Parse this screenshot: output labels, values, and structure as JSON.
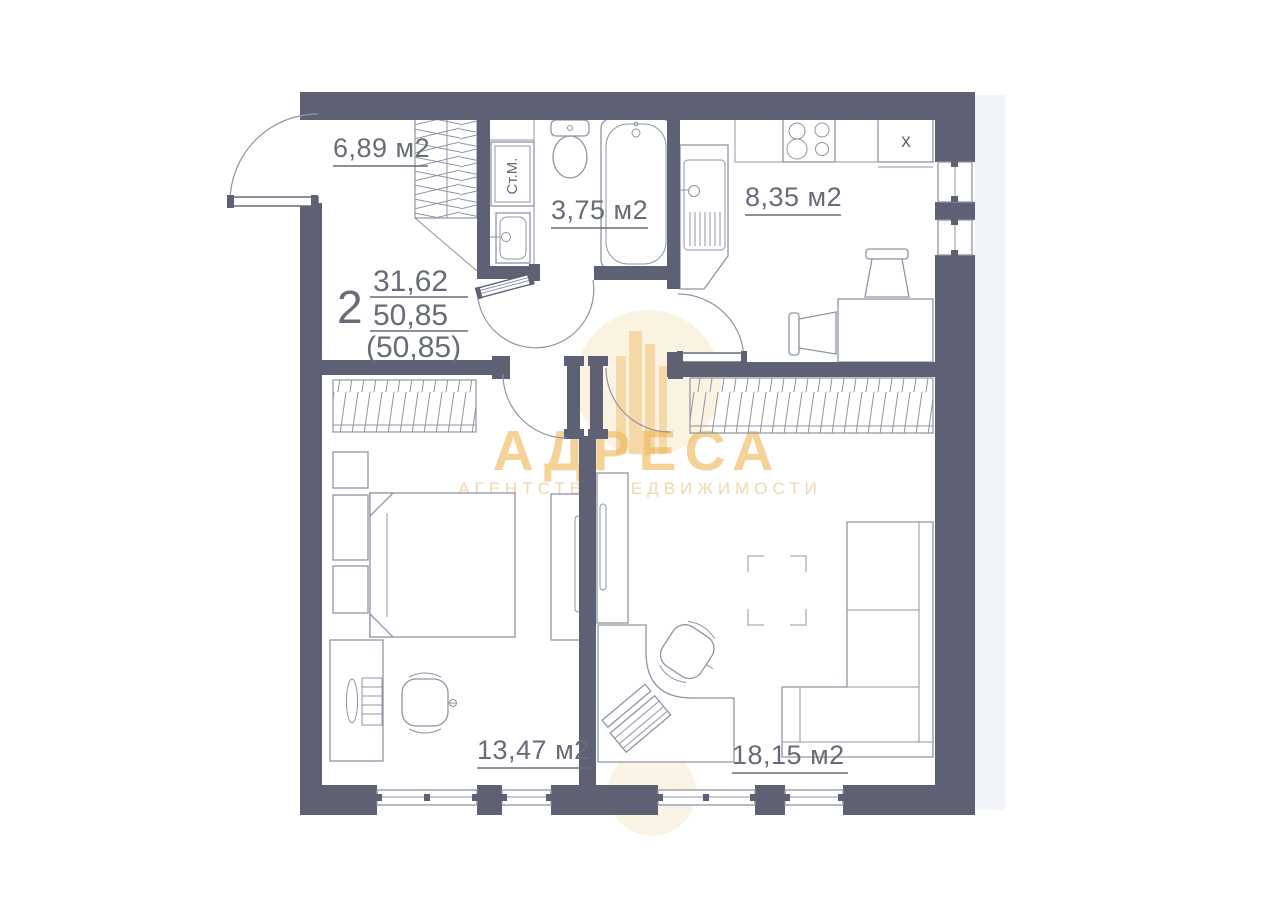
{
  "plan": {
    "apartment": {
      "number": "2",
      "area_living": "31,62",
      "area_total": "50,85",
      "area_total_paren": "(50,85)"
    },
    "rooms": {
      "hallway": {
        "area": "6,89 м2"
      },
      "bathroom": {
        "area": "3,75 м2"
      },
      "kitchen": {
        "area": "8,35 м2"
      },
      "bedroom": {
        "area": "13,47 м2"
      },
      "living": {
        "area": "18,15 м2"
      }
    },
    "fixtures": {
      "washing_machine": "Ст.М.",
      "fridge_cabinet": "x"
    },
    "watermark": {
      "brand": "АДРЕСА",
      "tagline": "АГЕНТСТВО НЕДВИЖИМОСТИ"
    },
    "colors": {
      "wall": "#5e6173",
      "line": "#9094a3",
      "text": "#686b78",
      "gold": "#edb453",
      "pale_gold": "#f8e9cb",
      "bars": "#f2d49b",
      "tag": "#e9c68c"
    }
  }
}
